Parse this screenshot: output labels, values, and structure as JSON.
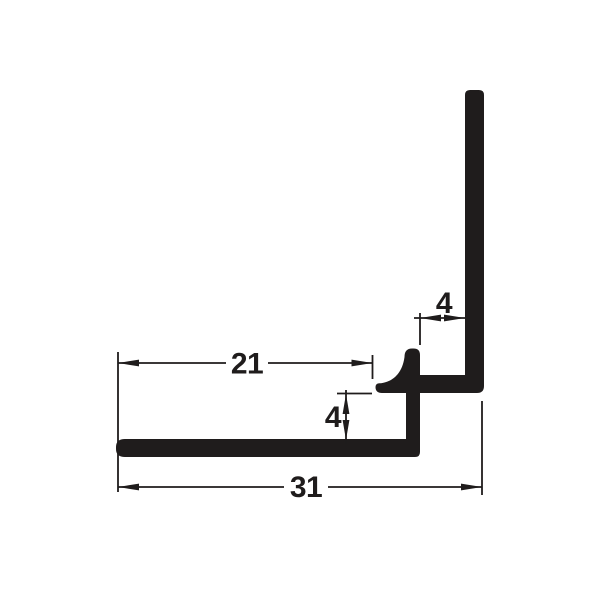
{
  "page": {
    "background_color": "#ffffff"
  },
  "diagram": {
    "type": "technical-dimension-drawing",
    "subject": "L-shaped panel edge profile cross-section",
    "ink_color": "#1f1c1c",
    "dimensions": {
      "top_slot_width": "4",
      "lip_inset_width": "21",
      "bottom_slot_height": "4",
      "overall_width": "31"
    }
  }
}
